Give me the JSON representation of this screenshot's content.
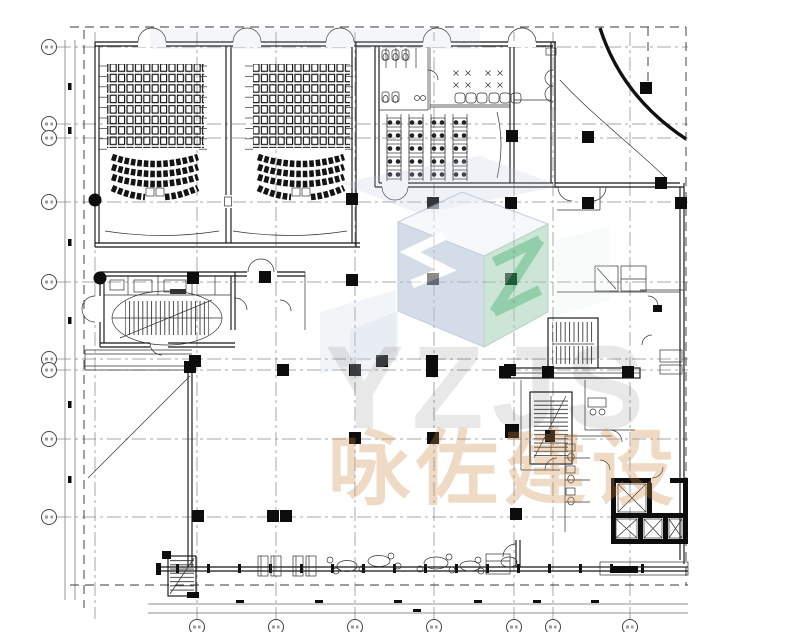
{
  "page": {
    "title": "Architectural floor plan drawing",
    "background": "#ffffff"
  },
  "watermark": {
    "brand_acronym": "YZJS",
    "brand_name": "咏佐建设",
    "logo_cube_blue": "#aebdd4",
    "logo_cube_green": "#9fcfb4",
    "logo_accent_green": "#2fa35c",
    "logo_letter_white": "#ffffff",
    "acronym_color": "#e8e8e8",
    "brand_name_color": "#c9863f"
  },
  "plan": {
    "grid": {
      "v": [
        197,
        276,
        355,
        434,
        514,
        553,
        630
      ],
      "v2": [
        95
      ],
      "h": [
        47,
        124,
        138,
        202,
        282,
        359,
        370,
        439,
        517
      ],
      "aux": [
        [
          65,
          40,
          65,
          600
        ],
        [
          75,
          40,
          75,
          600
        ],
        [
          148,
          604,
          688,
          604
        ],
        [
          148,
          613,
          688,
          613
        ]
      ],
      "dashed": [
        [
          84,
          30,
          84,
          608
        ],
        [
          70,
          27,
          686,
          27
        ],
        [
          686,
          27,
          686,
          585
        ],
        [
          70,
          585,
          688,
          585
        ],
        [
          648,
          27,
          648,
          83
        ]
      ]
    },
    "columns": [
      [
        352,
        199
      ],
      [
        433,
        203
      ],
      [
        511,
        203
      ],
      [
        588,
        203
      ],
      [
        681,
        203
      ],
      [
        512,
        136
      ],
      [
        588,
        137
      ],
      [
        193,
        278
      ],
      [
        265,
        277
      ],
      [
        352,
        280
      ],
      [
        433,
        279
      ],
      [
        511,
        279
      ],
      [
        195,
        361
      ],
      [
        382,
        361
      ],
      [
        432,
        361
      ],
      [
        283,
        370
      ],
      [
        355,
        370
      ],
      [
        432,
        371
      ],
      [
        510,
        370
      ],
      [
        190,
        367
      ],
      [
        355,
        438
      ],
      [
        433,
        438
      ],
      [
        198,
        516
      ],
      [
        273,
        516
      ],
      [
        286,
        516
      ],
      [
        516,
        514
      ],
      [
        505,
        372
      ],
      [
        548,
        372
      ],
      [
        628,
        372
      ],
      [
        661,
        183
      ],
      [
        646,
        88
      ]
    ],
    "big_columns": [
      [
        512,
        431
      ]
    ],
    "dots": [
      [
        95,
        200
      ],
      [
        100,
        278
      ]
    ],
    "ticks_left": [
      [
        68,
        83
      ],
      [
        68,
        127
      ],
      [
        68,
        239
      ],
      [
        68,
        317
      ],
      [
        68,
        401
      ],
      [
        68,
        476
      ]
    ],
    "ticks_bottom": [
      [
        236,
        600
      ],
      [
        315,
        600
      ],
      [
        394,
        600
      ],
      [
        474,
        600
      ],
      [
        533,
        600
      ],
      [
        591,
        600
      ],
      [
        413,
        609
      ]
    ],
    "combs": [
      [
        99,
        107
      ],
      [
        199,
        207
      ],
      [
        245,
        253
      ],
      [
        345,
        353
      ]
    ],
    "dining_cols": [
      385,
      407,
      429,
      451
    ],
    "dining_rows": [
      118,
      131,
      144,
      157,
      170
    ],
    "clusters": [
      [
        462,
        79
      ],
      [
        494,
        79
      ]
    ],
    "sofas": [
      455,
      466,
      477,
      489,
      500,
      511
    ],
    "ovals": [
      [
        347,
        566,
        10,
        5.5
      ],
      [
        379,
        561,
        11,
        5.5
      ],
      [
        436,
        563,
        12,
        6
      ],
      [
        470,
        566,
        10,
        5
      ],
      [
        509,
        562,
        8,
        5
      ]
    ],
    "small_circles": [
      [
        330,
        560
      ],
      [
        336,
        571
      ],
      [
        362,
        569
      ],
      [
        391,
        556
      ],
      [
        398,
        566
      ],
      [
        420,
        569
      ],
      [
        449,
        557
      ],
      [
        452,
        570
      ],
      [
        478,
        560
      ],
      [
        481,
        571
      ]
    ],
    "chair_pairs": [
      258,
      271,
      293,
      306
    ],
    "curved_row_baseys": [
      157,
      167,
      177
    ],
    "theaters": [
      {
        "cx": 155,
        "x1": 112,
        "x2": 198
      },
      {
        "cx": 301,
        "x1": 258,
        "x2": 344
      }
    ]
  }
}
